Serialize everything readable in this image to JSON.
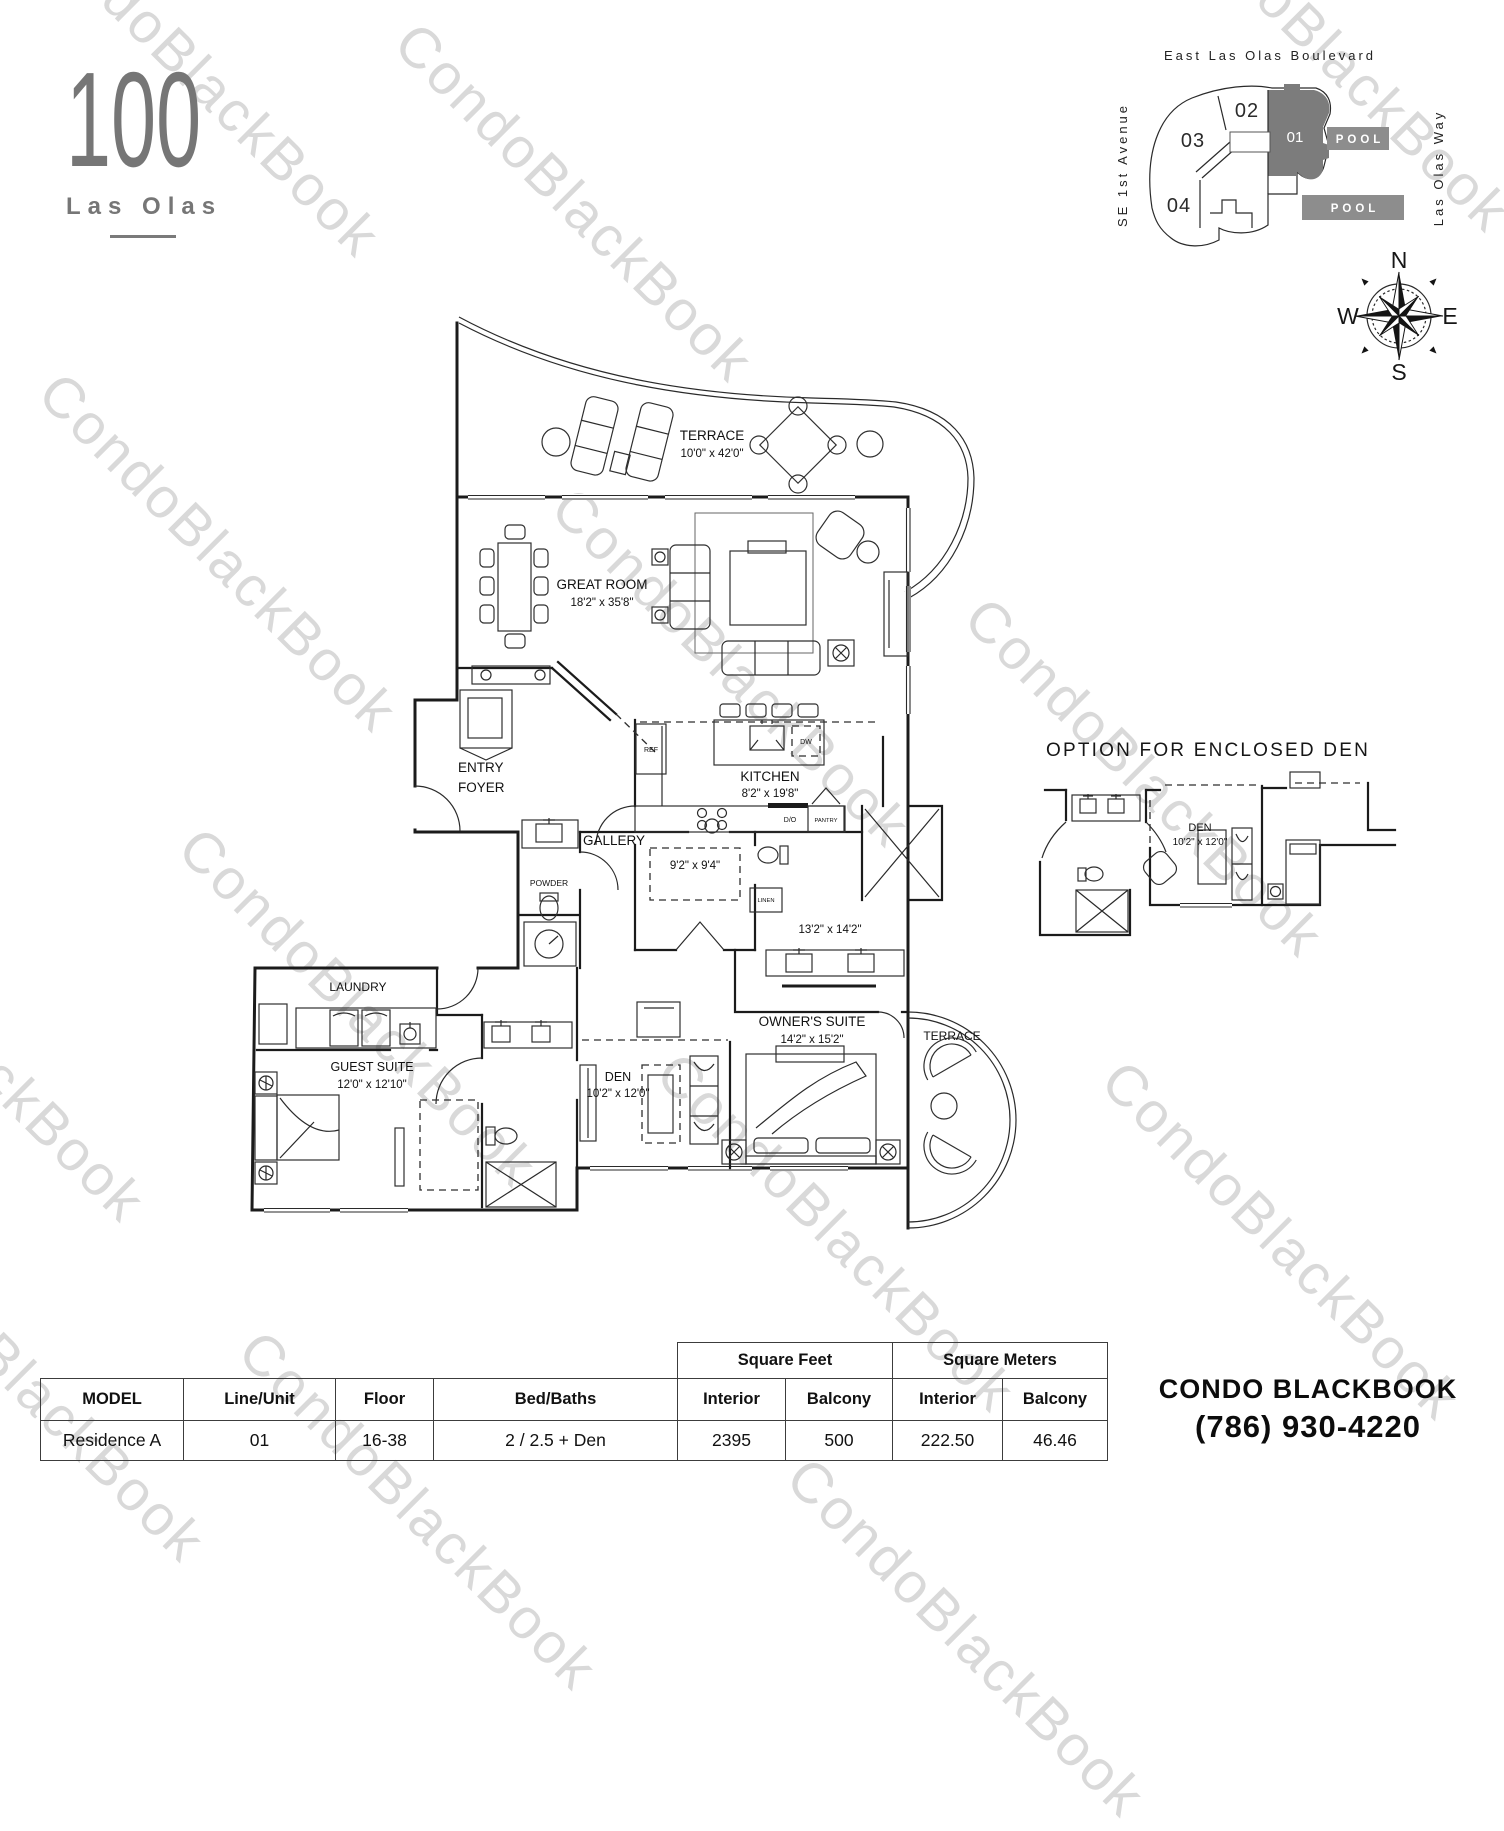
{
  "watermark": {
    "text": "CondoBlackBook"
  },
  "logo": {
    "number": "100",
    "name": "Las Olas"
  },
  "site_map": {
    "street_top": "East Las Olas Boulevard",
    "street_left": "SE 1st Avenue",
    "street_right": "Las Olas Way",
    "unit_02": "02",
    "unit_03": "03",
    "unit_04": "04",
    "unit_01": "01",
    "pool": "POOL"
  },
  "compass": {
    "n": "N",
    "e": "E",
    "s": "S",
    "w": "W"
  },
  "floor_plan": {
    "rooms": {
      "terrace_top": {
        "name": "TERRACE",
        "dims": "10'0\" x 42'0\""
      },
      "great_room": {
        "name": "GREAT ROOM",
        "dims": "18'2\" x 35'8\""
      },
      "entry_foyer": {
        "line1": "ENTRY",
        "line2": "FOYER"
      },
      "gallery": {
        "name": "GALLERY"
      },
      "powder": {
        "name": "POWDER"
      },
      "kitchen": {
        "name": "KITCHEN",
        "dims": "8'2\" x 19'8\""
      },
      "nook": {
        "dims": "9'2\" x 9'4\""
      },
      "owner_bath": {
        "dims": "13'2\" x 14'2\""
      },
      "laundry": {
        "name": "LAUNDRY"
      },
      "guest_suite": {
        "name": "GUEST SUITE",
        "dims": "12'0\" x 12'10\""
      },
      "den": {
        "name": "DEN",
        "dims": "10'2\" x 12'0\""
      },
      "owner_suite": {
        "name": "OWNER'S SUITE",
        "dims": "14'2\" x 15'2\""
      },
      "terrace_right": {
        "name": "TERRACE"
      }
    },
    "fixtures": {
      "ref": "REF",
      "dw": "DW",
      "do_label": "D/O",
      "pantry": "PANTRY",
      "linen": "LINEN"
    }
  },
  "option_plan": {
    "title": "OPTION FOR ENCLOSED DEN",
    "den": {
      "name": "DEN",
      "dims": "10'2\" x 12'0\""
    }
  },
  "spec_table": {
    "group_headers": {
      "square_feet": "Square Feet",
      "square_meters": "Square Meters"
    },
    "columns": [
      "MODEL",
      "Line/Unit",
      "Floor",
      "Bed/Baths",
      "Interior",
      "Balcony",
      "Interior",
      "Balcony"
    ],
    "row": {
      "model": "Residence A",
      "line_unit": "01",
      "floor": "16-38",
      "bed_baths": "2 / 2.5 + Den",
      "sqft_interior": "2395",
      "sqft_balcony": "500",
      "sqm_interior": "222.50",
      "sqm_balcony": "46.46"
    }
  },
  "contact": {
    "name": "CONDO BLACKBOOK",
    "phone": "(786) 930-4220"
  }
}
